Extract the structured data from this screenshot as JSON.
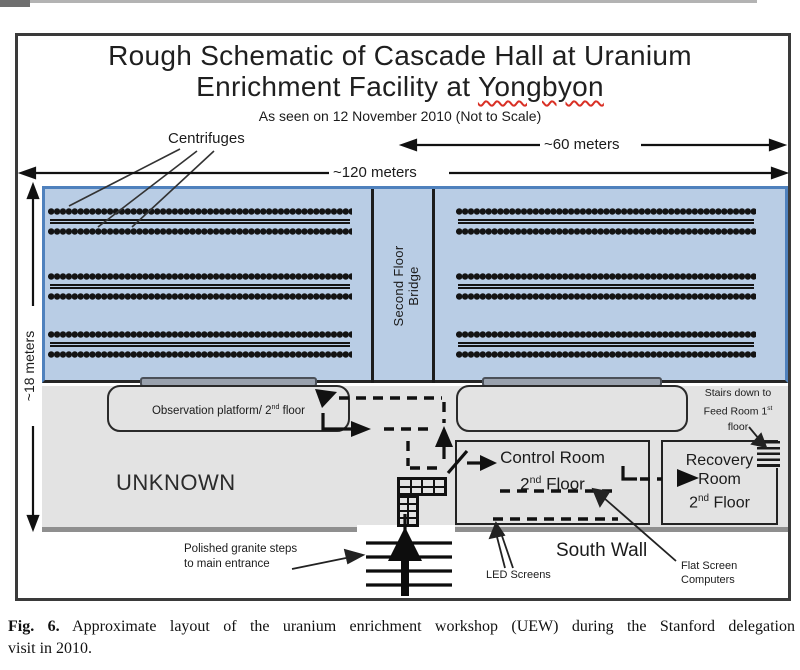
{
  "title": {
    "line1": "Rough Schematic of Cascade Hall at Uranium",
    "line2_pre": "Enrichment Facility at ",
    "line2_highlight": "Yongbyon"
  },
  "subtitle": "As seen on 12 November 2010 (Not to Scale)",
  "dimensions": {
    "width_total": "~120 meters",
    "width_right": "~60 meters",
    "height": "~18 meters"
  },
  "labels": {
    "centrifuges": "Centrifuges",
    "bridge": "Second Floor Bridge",
    "observation": {
      "pre": "Observation platform/ 2",
      "sup": "nd",
      "post": " floor"
    },
    "unknown": "UNKNOWN",
    "granite_line1": "Polished granite steps",
    "granite_line2": "to main entrance",
    "led_screens": "LED Screens",
    "south_wall": "South Wall",
    "flat_line1": "Flat Screen",
    "flat_line2": "Computers"
  },
  "rooms": {
    "control": {
      "line1": "Control Room",
      "floor_num": "2",
      "floor_sup": "nd",
      "floor_post": " Floor"
    },
    "recovery": {
      "line1": "Recovery",
      "line2": "Room",
      "floor_num": "2",
      "floor_sup": "nd",
      "floor_post": " Floor"
    },
    "stairs": {
      "line1": "Stairs down to",
      "line2_pre": "Feed Room 1",
      "sup": "st",
      "line3": "floor"
    }
  },
  "caption": {
    "bold": "Fig. 6.",
    "line1": " Approximate layout of the uranium enrichment workshop (UEW) during the Stanford delegation",
    "line2": "visit in 2010."
  },
  "colors": {
    "hall_fill": "#b9cde5",
    "hall_border": "#4f81bd",
    "floor_fill": "#e3e3e3",
    "wall_gray": "#8f8f8f",
    "ink": "#1b1b1b",
    "spellcheck_underline": "#d93025"
  }
}
